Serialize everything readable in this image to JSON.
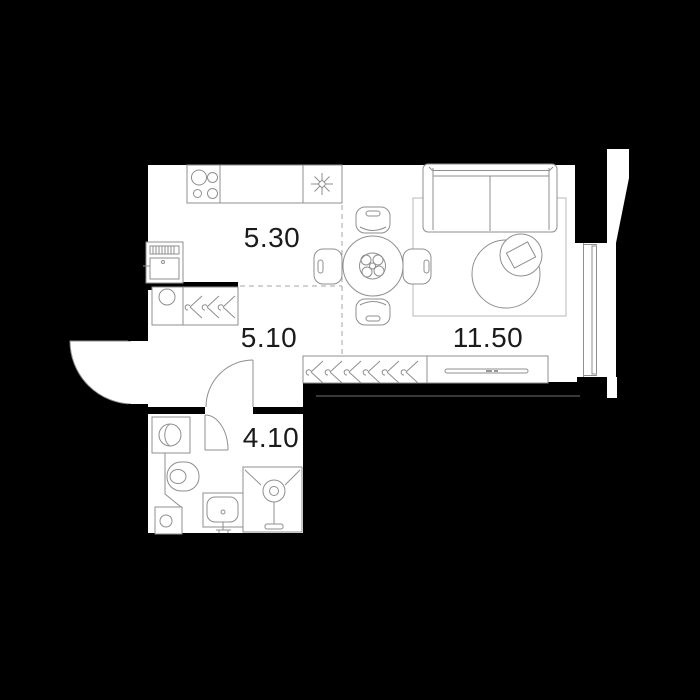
{
  "title": "Studio apartment floor plan",
  "floorplan": {
    "rooms": [
      {
        "id": "kitchen",
        "area_label": "5.30"
      },
      {
        "id": "hallway",
        "area_label": "5.10"
      },
      {
        "id": "living_room",
        "area_label": "11.50"
      },
      {
        "id": "bathroom",
        "area_label": "4.10"
      }
    ],
    "colors": {
      "background": "#000000",
      "walls": "#000000",
      "floor": "#ffffff",
      "furniture_line": "#8f8f8f",
      "zone_dash_line": "#a6a6a6",
      "balcony_edge_line": "#4a4a4a",
      "label_text": "#1b1b1b"
    }
  }
}
